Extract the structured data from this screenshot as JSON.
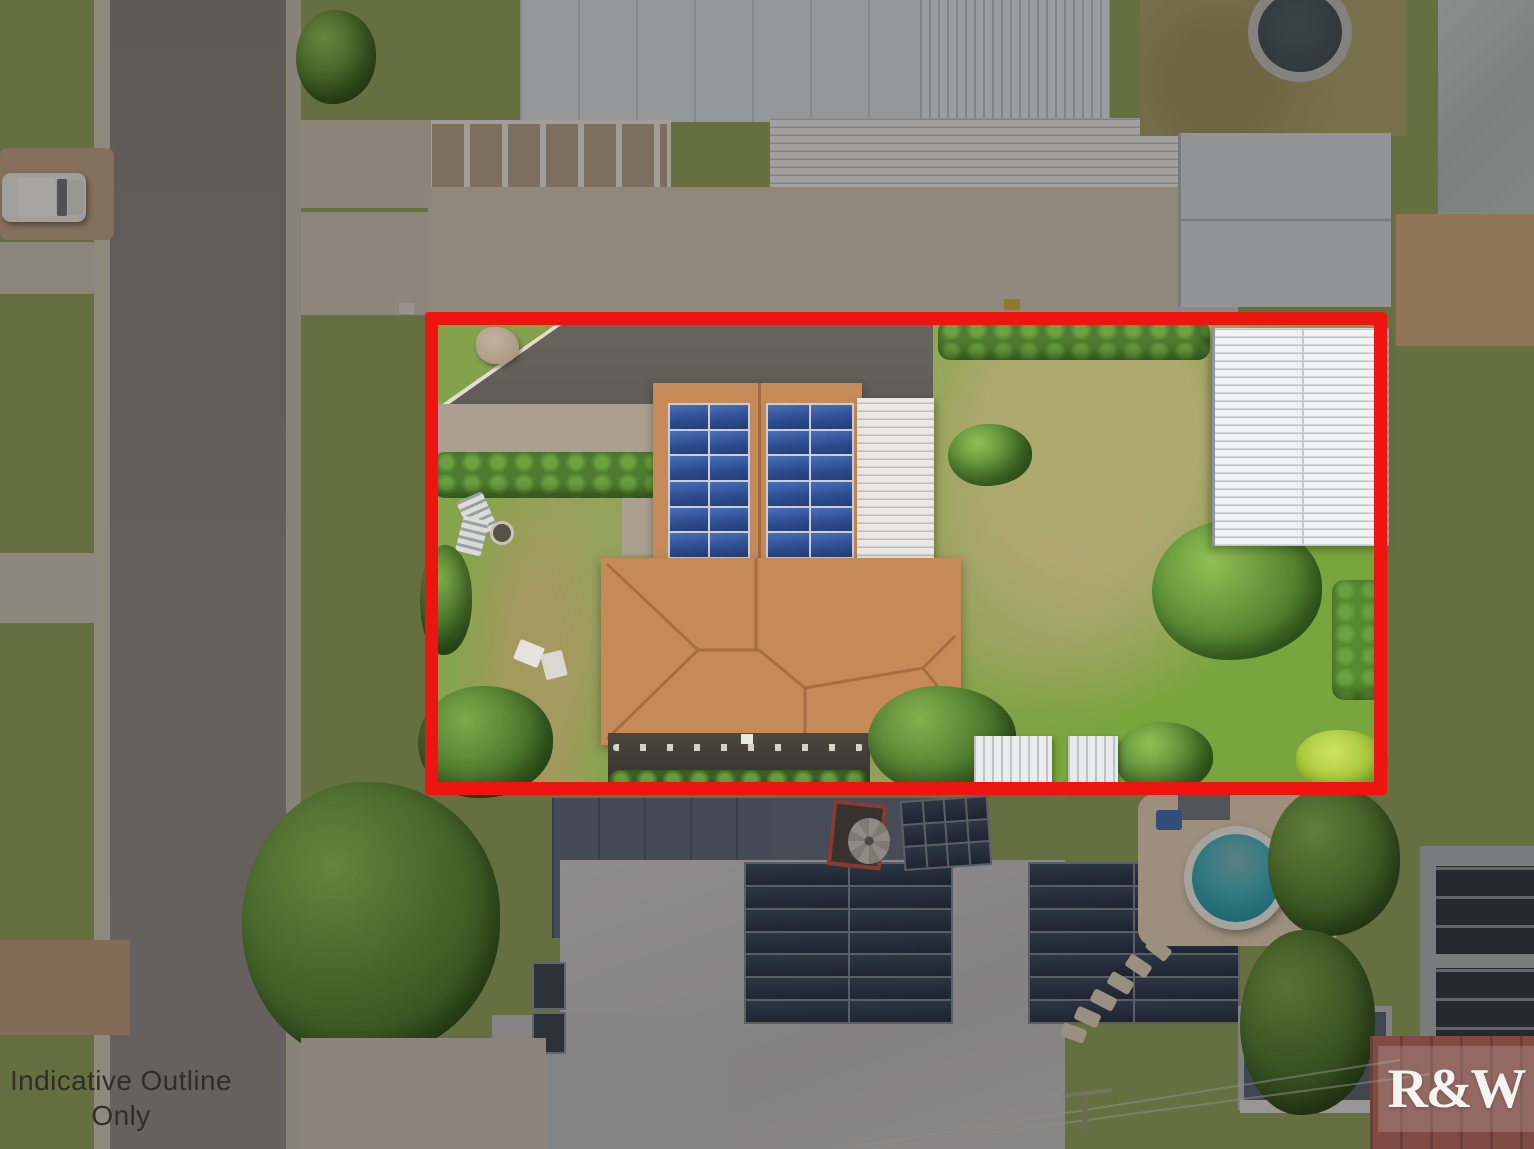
{
  "overlay": {
    "disclaimer": {
      "line1": "Indicative Outline",
      "line2": "Only",
      "text_color": "#332d27"
    },
    "watermark": {
      "text": "R&W",
      "text_color": "#f6f4f0"
    },
    "boundary": {
      "color": "#ee1511"
    }
  },
  "scene_colors": {
    "terracotta_roof": "#c68a59",
    "solar_panel_blue": "#2d4b8e",
    "pool_water_teal": "#3fbccb",
    "lawn_green": "#7da645",
    "road_gray": "#8a8480",
    "white_shed": "#edeff0"
  }
}
